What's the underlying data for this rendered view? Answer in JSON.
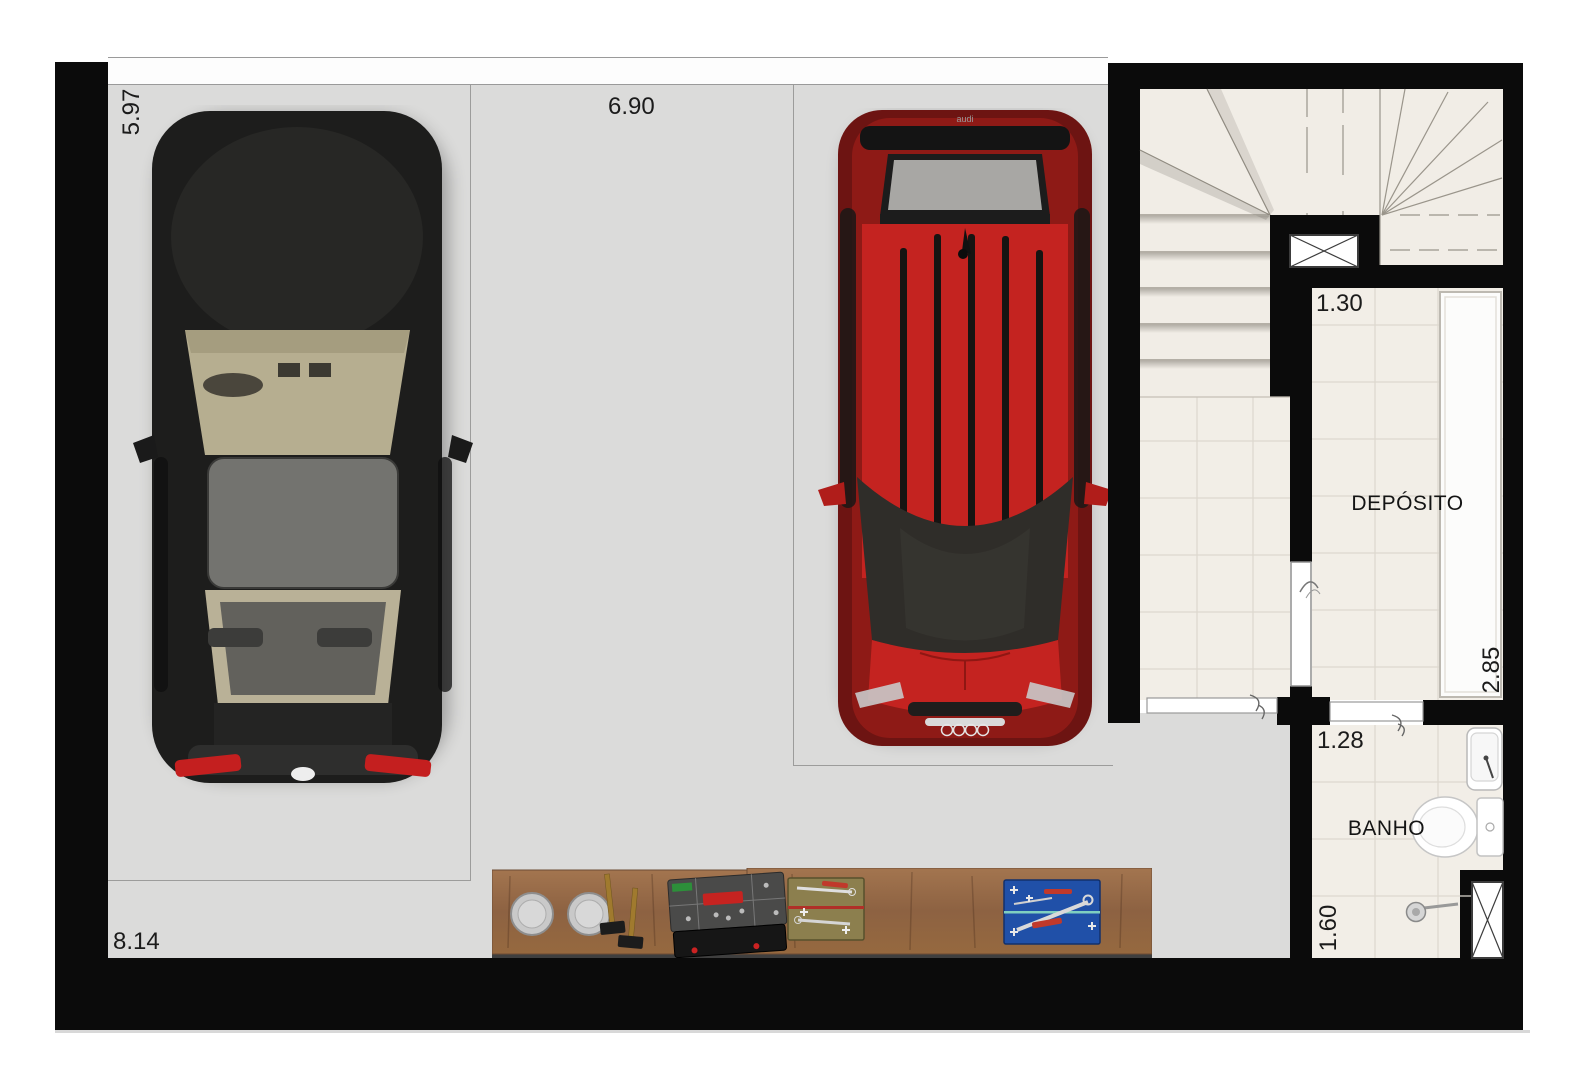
{
  "title": "Garage level floor plan",
  "garage": {
    "dim_left": "5.97",
    "dim_top": "6.90",
    "dim_bottom": "8.14"
  },
  "deposito": {
    "label": "DEPÓSITO",
    "dim_width": "1.30",
    "dim_depth": "2.85"
  },
  "banho": {
    "label": "BANHO",
    "dim_width": "1.28",
    "dim_depth": "1.60"
  },
  "red_car": {
    "brand": "audi"
  },
  "colors": {
    "wall": "#0b0b0b",
    "garage_floor": "#dbdbda",
    "tile_floor": "#f2eee7",
    "black_car_body": "#1d1d1c",
    "red_car_body": "#c42320",
    "taillight_red": "#c41f1f",
    "bench_wood": "#976b47",
    "tray_olive": "#8c7f4e",
    "tray_blue": "#2050a8",
    "rear_glass_grey": "#a8a7a4"
  }
}
